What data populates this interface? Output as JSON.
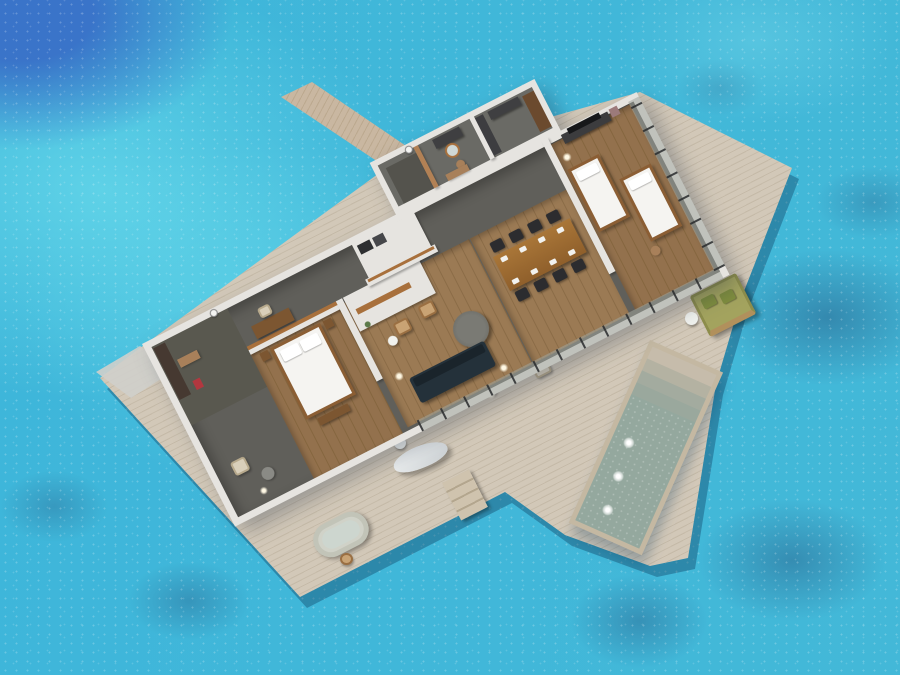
{
  "scene": {
    "title": "Aerial 3D floor plan of an overwater pool villa on a turquoise lagoon",
    "view": "top-down oblique 3D render",
    "environment": "tropical lagoon with coral patches and a deep-blue channel at top-left",
    "visible_text": "none"
  },
  "palette": {
    "water": "#3eb6da",
    "waterDeep": "#3a74c9",
    "reef": "#2c628c",
    "deck": "#d2c8b8",
    "deckLine": "#c5bAA8",
    "jetty": "#c9b7a1",
    "wall": "#e6e4e0",
    "floorDark": "#605f5a",
    "floorWood": "#93714d",
    "woodCap": "#a8703c",
    "woodDark": "#7c5631",
    "bedWhite": "#f5f4f1",
    "sofaNavy": "#24313a",
    "poolWater": "#94a89e",
    "daybedGreen": "#a3a35e",
    "chairDark": "#2c2c2f",
    "tub": "#d0d2c8"
  },
  "villa": {
    "structure": [
      "white perimeter walls",
      "glass wall on sea-facing sides with dark mullions",
      "wood-capped interior partitions",
      "protruding bathroom block on the lagoon side",
      "timber jetty walkway"
    ],
    "rooms": [
      {
        "name": "master-bedroom",
        "furniture": [
          "king bed with white duvet",
          "wooden headboard partition",
          "desk and chair",
          "bedside tables",
          "foot bench",
          "armchair",
          "ottoman",
          "dressing area with dark wood panel",
          "red artwork",
          "floor lantern"
        ]
      },
      {
        "name": "living-room",
        "furniture": [
          "navy sofa",
          "round grey coffee table",
          "two wooden armchairs",
          "white side table",
          "fireplace shelf wall",
          "floor lamps"
        ]
      },
      {
        "name": "dining-room",
        "furniture": [
          "long wooden dining table",
          "eight dark chairs",
          "white place settings"
        ]
      },
      {
        "name": "kitchen",
        "furniture": [
          "white counter",
          "dark appliances",
          "shelf divider wall"
        ]
      },
      {
        "name": "bathroom-one",
        "furniture": [
          "dark vanity",
          "round mirror",
          "wooden stool",
          "bench"
        ]
      },
      {
        "name": "bathroom-two",
        "furniture": [
          "dark vanity with mirror",
          "dark door",
          "tall wooden cabinet"
        ]
      },
      {
        "name": "twin-bedroom",
        "furniture": [
          "two twin beds with white linen",
          "TV console with television",
          "artwork",
          "pendant lantern",
          "pouf"
        ]
      }
    ]
  },
  "deck": {
    "features": [
      "round outdoor dining table with four wooden chairs",
      "olive-green double daybed with pillows",
      "white side table",
      "two deck loungers with white side tables",
      "outdoor oval stone bathtub with stool",
      "white curved hammock lounger",
      "timber steps down to the sea",
      "armchairs with dark round table and lantern by master bedroom",
      "grey entry pad at west corner"
    ]
  },
  "pool": {
    "shape": "long rectangle jutting into the lagoon",
    "steps": 4,
    "underwater_lights": 3
  },
  "ocean": {
    "features": [
      "deep blue channel top-left corner",
      "pale sandbar band upper-left",
      "scattered dark coral-reef patches right and bottom",
      "white ripple speckles"
    ]
  }
}
